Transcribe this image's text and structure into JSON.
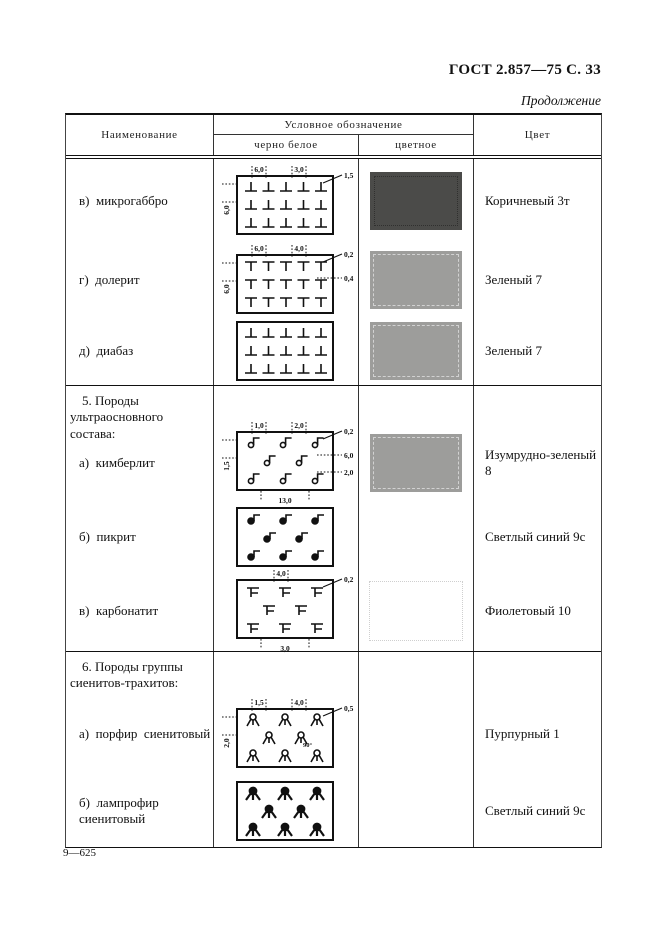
{
  "page": {
    "gost": "ГОСТ 2.857—75 С. 33",
    "continuation": "Продолжение",
    "footer": "9—625"
  },
  "table": {
    "col_name": "Наименование",
    "col_designation": "Условное обозначение",
    "col_bw": "черно белое",
    "col_color": "цветное",
    "col_colorname": "Цвет",
    "sections": [
      {
        "title": "",
        "rows": [
          {
            "name": "в)  микрогаббро",
            "glyph": "uptack",
            "layout": "5x3",
            "dims": {
              "top": [
                "6,0",
                "3,0"
              ],
              "left": "6,0",
              "right": [
                "1,5"
              ]
            },
            "swatch": "#4b4b49",
            "swatch_style": "dark",
            "color": "Коричневый 3т"
          },
          {
            "name": "г)  долерит",
            "glyph": "tee",
            "layout": "5x3",
            "dims": {
              "top": [
                "6,0",
                "4,0"
              ],
              "left": "6,0",
              "right": [
                "0,2",
                "0,4"
              ]
            },
            "swatch": "#9d9d9b",
            "swatch_style": "gray",
            "color": "Зеленый 7"
          },
          {
            "name": "д)  диабаз",
            "glyph": "uptack",
            "layout": "5x3",
            "dims": {},
            "swatch": "#9d9d9b",
            "swatch_style": "gray",
            "color": "Зеленый 7"
          }
        ]
      },
      {
        "title": "5. Породы ультраосновного состава:",
        "rows": [
          {
            "name": "а)  кимберлит",
            "glyph": "kimb",
            "layout": "323",
            "dims": {
              "top": [
                "1,0",
                "2,0"
              ],
              "left": "1,5",
              "right": [
                "0,2",
                "6,0",
                "2,0"
              ],
              "bottom": "13,0"
            },
            "swatch": "#9d9d9b",
            "swatch_style": "gray",
            "color": "Изумрудно-зеленый 8"
          },
          {
            "name": "б)  пикрит",
            "glyph": "note",
            "layout": "323",
            "dims": {},
            "swatch": null,
            "color": "Светлый синий 9с"
          },
          {
            "name": "в)  карбонатит",
            "glyph": "carb",
            "layout": "323",
            "dims": {
              "top": [
                "4,0"
              ],
              "right": [
                "0,2"
              ],
              "bottom": "3,0"
            },
            "swatch": null,
            "ghost": true,
            "color": "Фиолетовый 10"
          }
        ]
      },
      {
        "title": "6. Породы группы сиенитов-трахитов:",
        "rows": [
          {
            "name": "а)  порфир  сиенитовый",
            "glyph": "tripod",
            "layout": "323",
            "dims": {
              "top": [
                "1,5",
                "4,0"
              ],
              "left": "2,0",
              "right": [
                "0,5"
              ],
              "note": "90°"
            },
            "swatch": null,
            "color": "Пурпурный 1"
          },
          {
            "name": "б)  лампрофир  сиенитовый",
            "glyph": "ftripod",
            "layout": "323",
            "dims": {},
            "swatch": null,
            "color": "Светлый синий 9с"
          }
        ]
      }
    ]
  }
}
